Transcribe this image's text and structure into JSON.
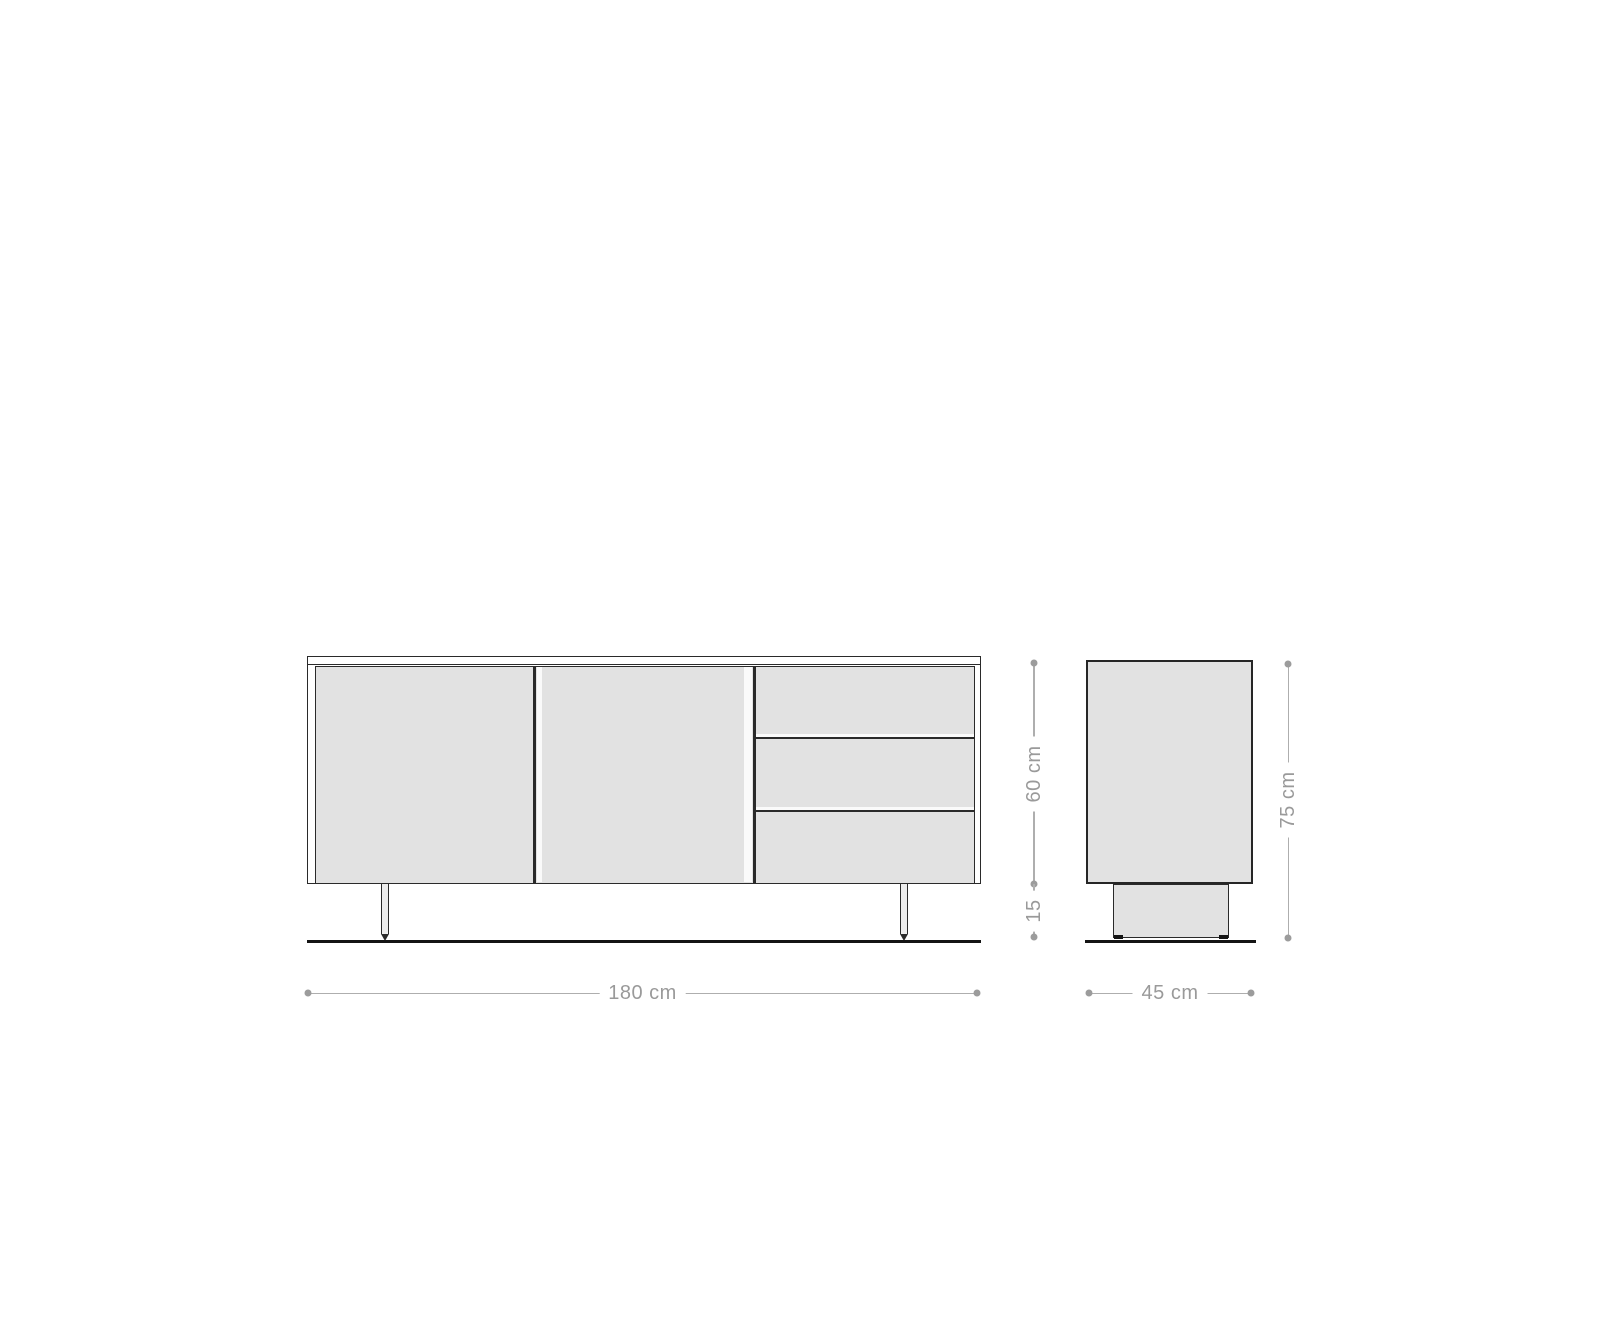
{
  "drawing": {
    "kind": "sideboard-dimension-drawing",
    "views": {
      "front": {
        "doors": 2,
        "drawers": 3,
        "legs": 2
      },
      "side": {
        "base": 1
      }
    }
  },
  "labels": {
    "width": "180 cm",
    "depth": "45 cm",
    "body_height": "60 cm",
    "base_height": "15",
    "total_height": "75 cm"
  },
  "colors": {
    "panel_fill": "#e2e2e2",
    "outline": "#2a2a2a",
    "ground": "#141414",
    "dimension_line": "#aeaeae",
    "dimension_dot": "#9c9c9c",
    "dimension_text": "#9a9a9a",
    "background": "#ffffff"
  }
}
